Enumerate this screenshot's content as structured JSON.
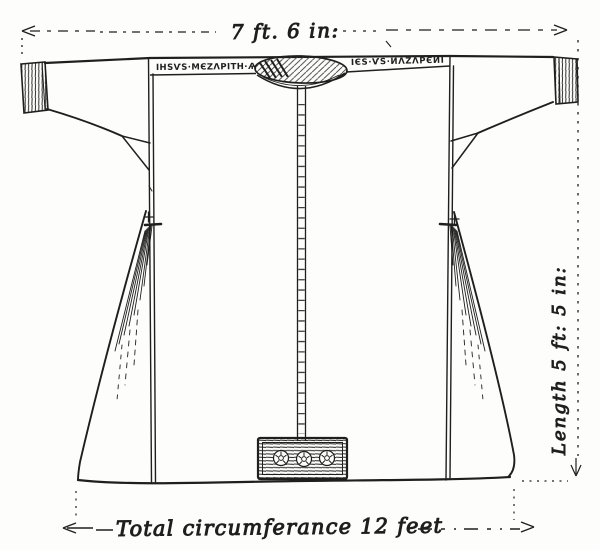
{
  "figure": {
    "type": "hand-drawn garment diagram",
    "subject": "seamless tunic (robe) front view with measurement annotations",
    "ink_color": "#1f1f1f",
    "paper_color": "#fdfdfb"
  },
  "dimensions": {
    "top_width": "7 ft. 6 in:",
    "side_length": "Length 5 ft: 5 in:",
    "bottom_circumference": "Total circumferance 12 feet"
  },
  "inscription": {
    "legible": false,
    "left": "ІНЅѴЅ·МЄΖΛРІТН·Ѧ",
    "right": "ІЄЅ·ѴЅ·ИΛΖΛРЄИІ"
  }
}
